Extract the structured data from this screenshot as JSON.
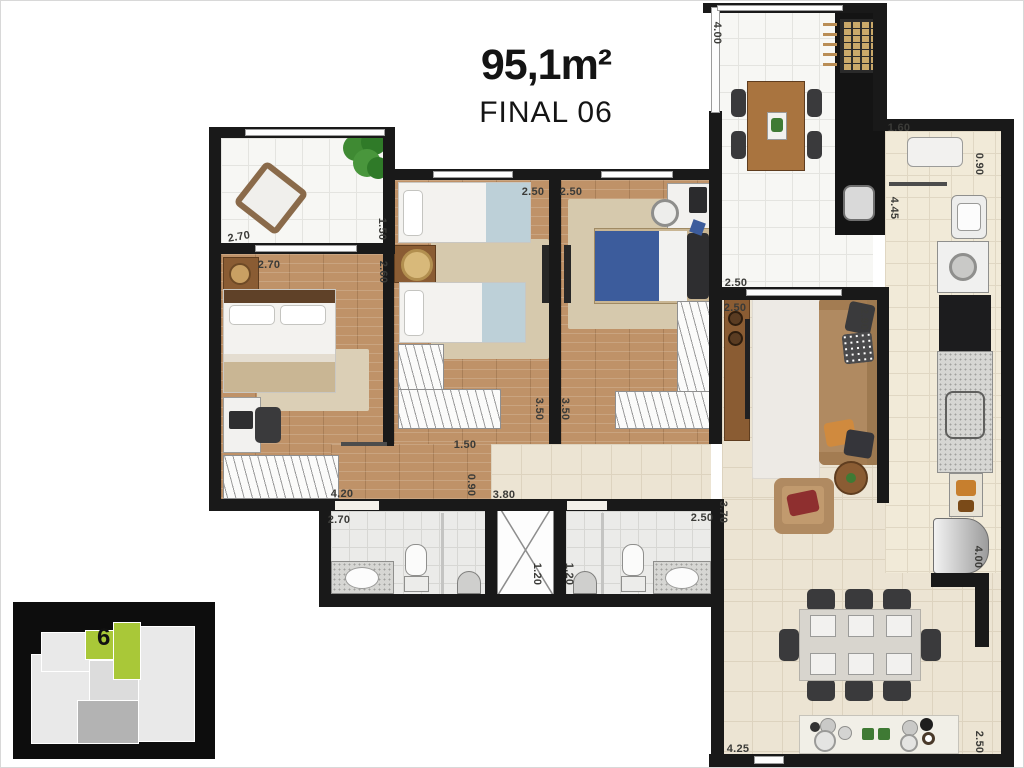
{
  "header": {
    "area": "95,1m²",
    "unit_label": "FINAL 06"
  },
  "inset": {
    "unit_number": "6",
    "highlight_color": "#a9c838"
  },
  "colors": {
    "wall": "#191919",
    "wood_floor": "#bf9268",
    "tile_beige": "#ece4d3",
    "accent_green": "#a9c838"
  },
  "dimensions": [
    {
      "t": "4.00",
      "x": 716,
      "y": 32,
      "rot": 90
    },
    {
      "t": "1.50",
      "x": 381,
      "y": 228,
      "rot": 90
    },
    {
      "t": "2.70",
      "x": 238,
      "y": 236,
      "rot": -10
    },
    {
      "t": "2.70",
      "x": 268,
      "y": 264,
      "rot": 0
    },
    {
      "t": "2.60",
      "x": 382,
      "y": 271,
      "rot": 90
    },
    {
      "t": "2.50",
      "x": 532,
      "y": 191,
      "rot": 0
    },
    {
      "t": "2.50",
      "x": 570,
      "y": 191,
      "rot": 0
    },
    {
      "t": "3.50",
      "x": 538,
      "y": 408,
      "rot": 90
    },
    {
      "t": "3.50",
      "x": 564,
      "y": 408,
      "rot": 90
    },
    {
      "t": "1.50",
      "x": 464,
      "y": 444,
      "rot": 0
    },
    {
      "t": "0.90",
      "x": 470,
      "y": 484,
      "rot": 90
    },
    {
      "t": "3.80",
      "x": 503,
      "y": 494,
      "rot": 0
    },
    {
      "t": "4.20",
      "x": 341,
      "y": 493,
      "rot": 0
    },
    {
      "t": "2.70",
      "x": 338,
      "y": 519,
      "rot": 0
    },
    {
      "t": "1.20",
      "x": 536,
      "y": 573,
      "rot": 90
    },
    {
      "t": "1.20",
      "x": 568,
      "y": 573,
      "rot": 90
    },
    {
      "t": "2.50",
      "x": 701,
      "y": 517,
      "rot": 0
    },
    {
      "t": "3.70",
      "x": 722,
      "y": 511,
      "rot": 90
    },
    {
      "t": "2.50",
      "x": 735,
      "y": 282,
      "rot": 0
    },
    {
      "t": "2.50",
      "x": 734,
      "y": 307,
      "rot": 0
    },
    {
      "t": "2.90",
      "x": 863,
      "y": 318,
      "rot": 90
    },
    {
      "t": "1.60",
      "x": 898,
      "y": 127,
      "rot": 0
    },
    {
      "t": "0.90",
      "x": 978,
      "y": 163,
      "rot": 90
    },
    {
      "t": "4.45",
      "x": 893,
      "y": 207,
      "rot": 90
    },
    {
      "t": "4.00",
      "x": 977,
      "y": 556,
      "rot": 90
    },
    {
      "t": "4.25",
      "x": 737,
      "y": 748,
      "rot": 0
    },
    {
      "t": "2.50",
      "x": 978,
      "y": 741,
      "rot": 90
    }
  ]
}
